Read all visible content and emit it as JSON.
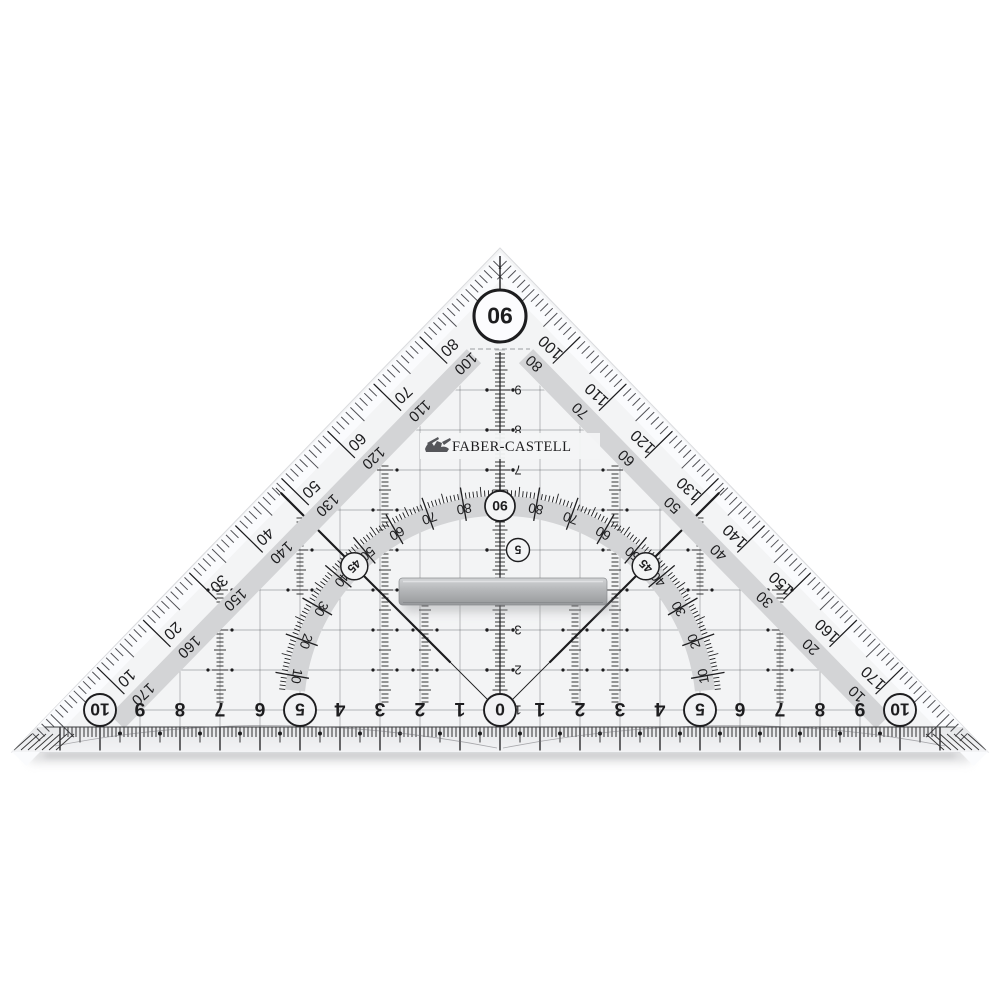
{
  "product": {
    "brand": "FABER-CASTELL",
    "item": "geometry set square (Geodreieck) with grip bar",
    "apex_angle_label": "90",
    "protractor_top_label": "90",
    "diagonal_angle_label": "45"
  },
  "colors": {
    "background": "#ffffff",
    "body": "#f3f4f5",
    "bevel": "#fafbfd",
    "band": "#d3d4d6",
    "ink": "#1d1d1f",
    "grid": "#4a4b4f",
    "logo": "#4b4c4f",
    "handle": "#b4b6b8"
  },
  "bottom_ruler": {
    "unit": "cm",
    "unit_numbers": [
      "10",
      "9",
      "8",
      "7",
      "6",
      "5",
      "4",
      "3",
      "2",
      "1",
      "0",
      "1",
      "2",
      "3",
      "4",
      "5",
      "6",
      "7",
      "8",
      "9",
      "10"
    ],
    "circled_values": [
      "0",
      "5",
      "10"
    ]
  },
  "vertical_scale": {
    "numbers": [
      "1",
      "2",
      "3",
      "4",
      "5",
      "6",
      "7",
      "8",
      "9"
    ],
    "circled_value": "5"
  },
  "left_edge": {
    "outer_scale": [
      "10",
      "20",
      "30",
      "40",
      "50",
      "60",
      "70",
      "80"
    ],
    "band_scale": [
      "170",
      "160",
      "150",
      "140",
      "130",
      "120",
      "110",
      "100"
    ]
  },
  "right_edge": {
    "outer_scale": [
      "170",
      "160",
      "150",
      "140",
      "130",
      "120",
      "110",
      "100"
    ],
    "band_scale": [
      "10",
      "20",
      "30",
      "40",
      "50",
      "60",
      "70",
      "80"
    ]
  },
  "protractor_arc": {
    "left_labels": [
      "10",
      "20",
      "30",
      "40",
      "50",
      "60",
      "70",
      "80"
    ],
    "right_labels": [
      "10",
      "20",
      "30",
      "40",
      "50",
      "60",
      "70",
      "80"
    ],
    "top_label": "90",
    "circled_left": "45",
    "circled_right": "45"
  }
}
